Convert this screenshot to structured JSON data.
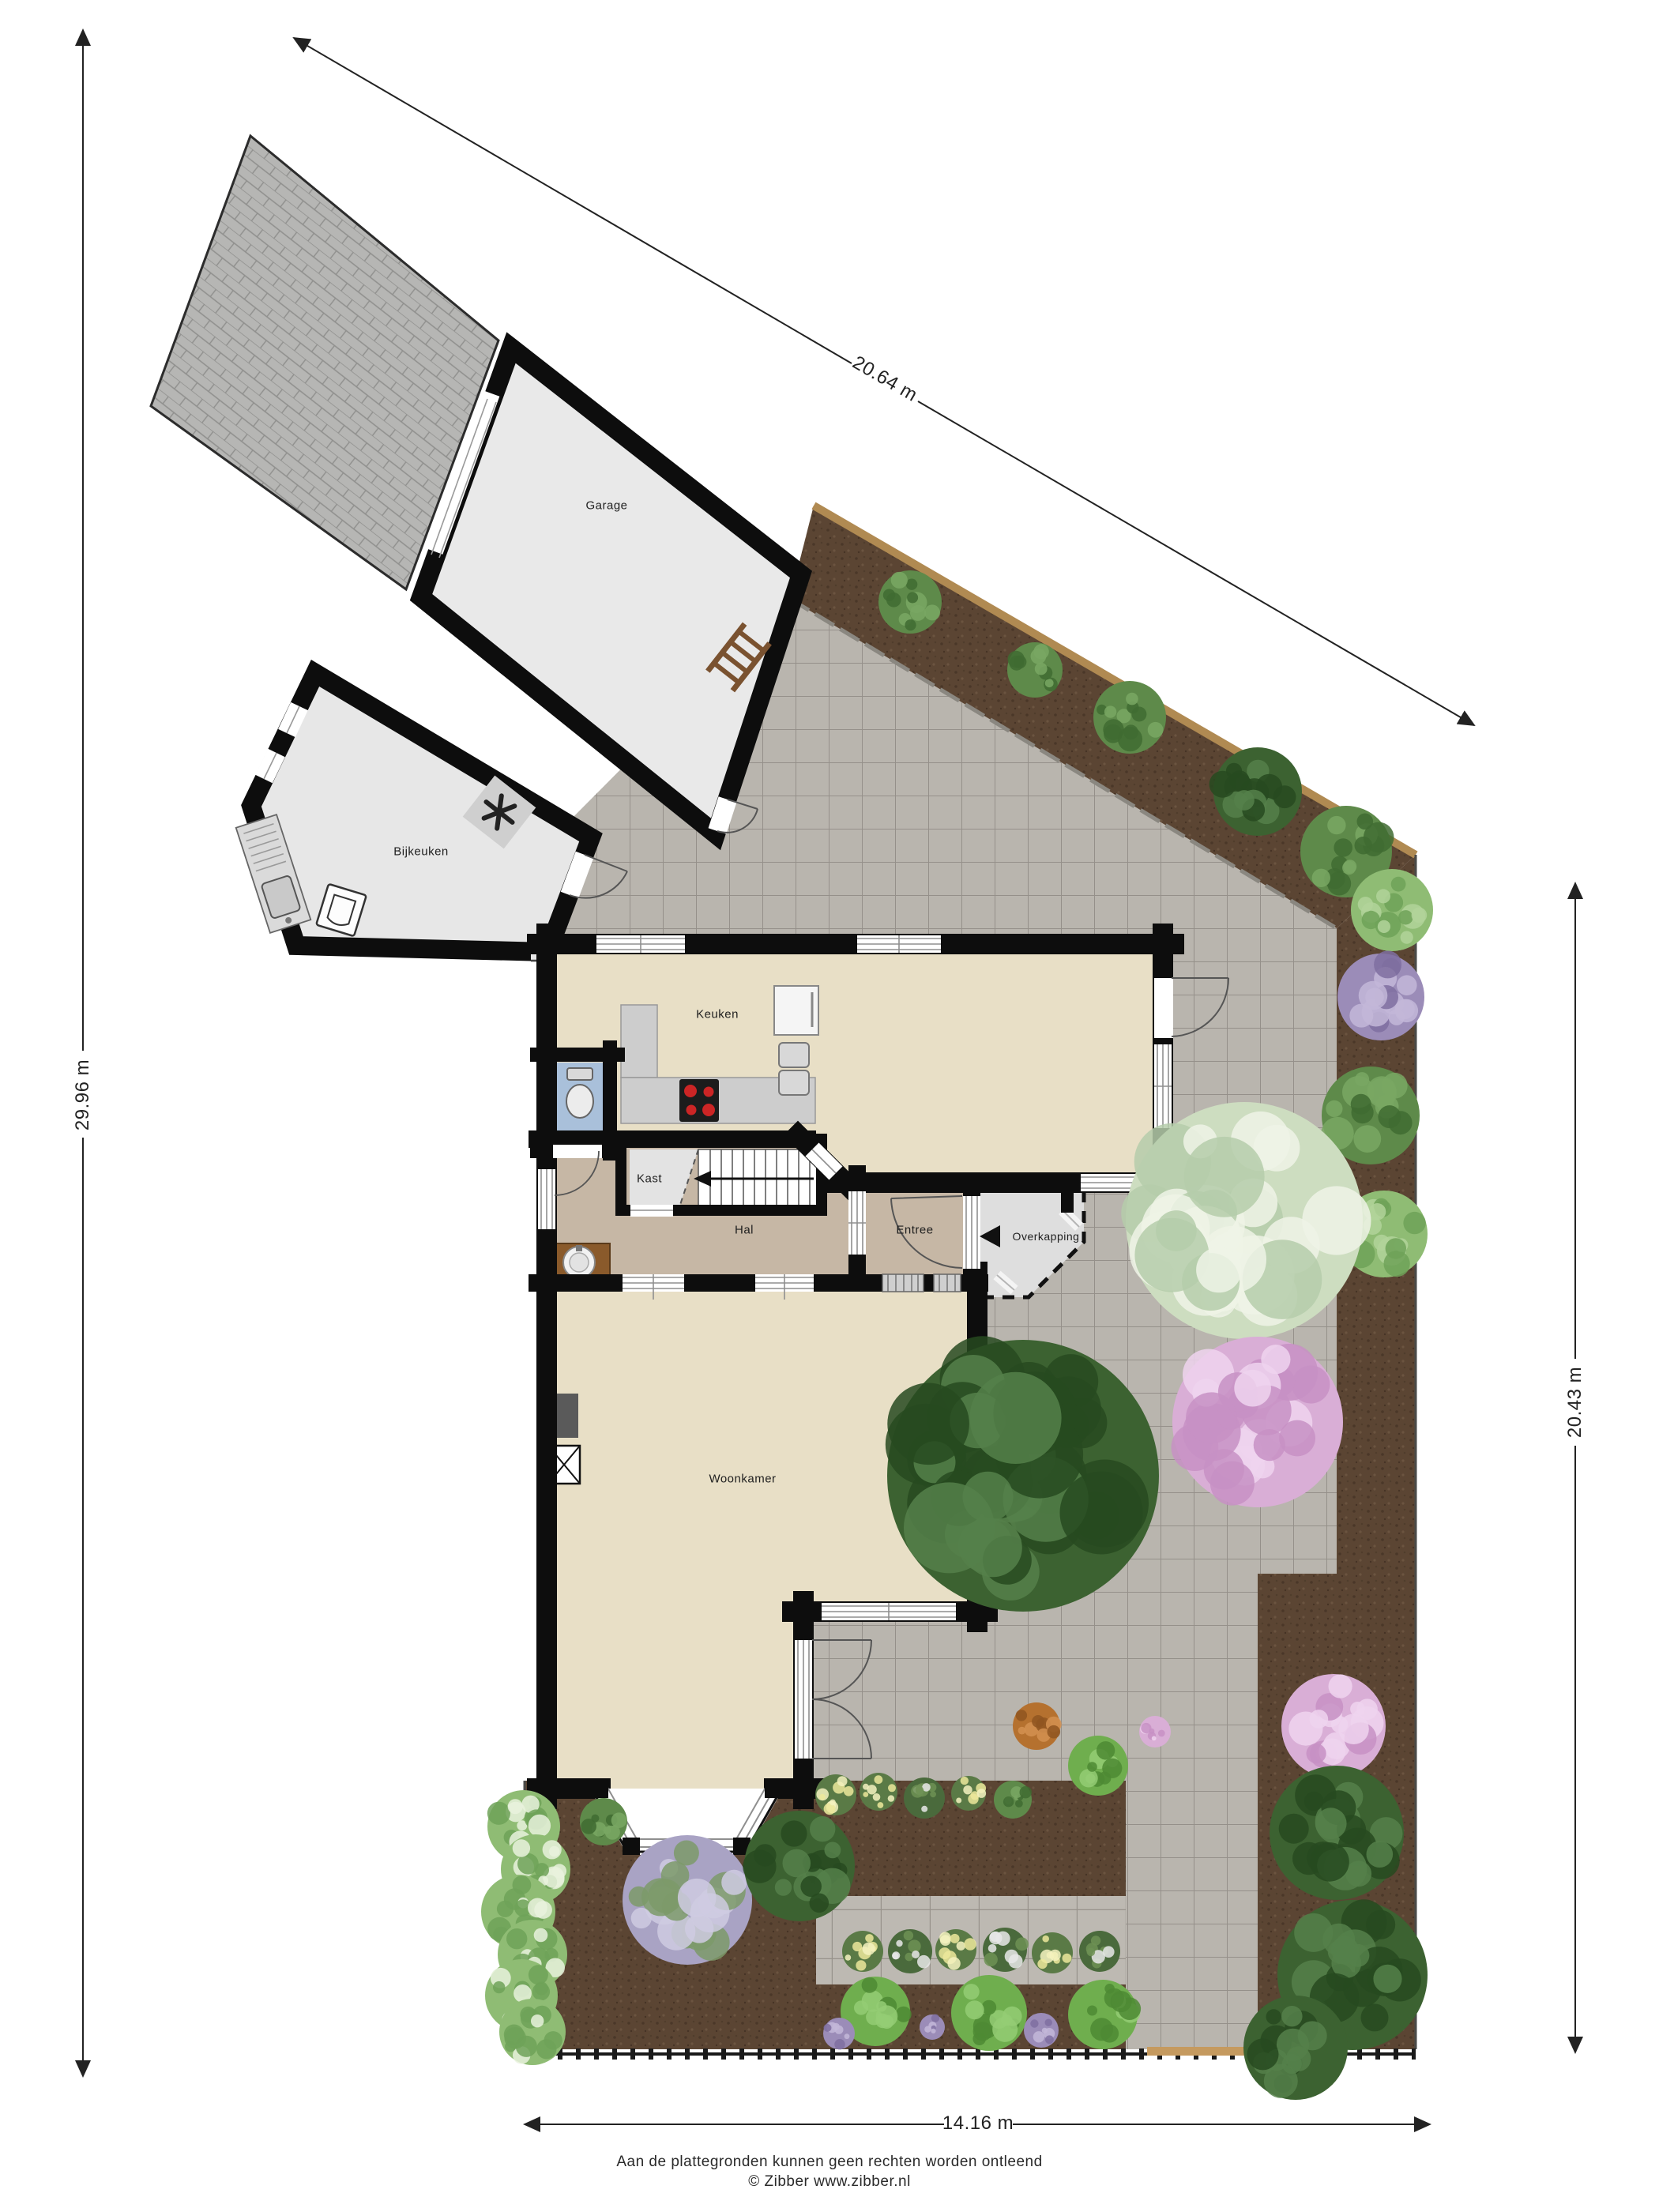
{
  "plan": {
    "rooms": {
      "garage": "Garage",
      "bijkeuken": "Bijkeuken",
      "keuken": "Keuken",
      "kast": "Kast",
      "hal": "Hal",
      "entree": "Entree",
      "overkapping": "Overkapping",
      "woonkamer": "Woonkamer"
    },
    "dimensions": {
      "top": "20.64 m",
      "left": "29.96 m",
      "right": "20.43 m",
      "bottom": "14.16 m"
    },
    "footer": {
      "line1": "Aan de plattegronden kunnen geen rechten worden ontleend",
      "line2": "© Zibber www.zibber.nl"
    },
    "icons": {
      "toilet": "toilet-icon",
      "stove": "stove-icon",
      "sink": "sink-icon",
      "fridge": "cabinet-icon",
      "washer": "washing-machine-icon",
      "fan": "ventilation-icon",
      "ladder": "ladder-icon",
      "basin": "washbasin-icon",
      "fireplace": "fireplace-icon",
      "stairs": "stairs-icon",
      "direction_arrow": "left-arrow-icon"
    },
    "colors": {
      "wall": "#0d0d0d",
      "living_floor": "#e8dfc6",
      "hall_floor": "#c6b7a5",
      "utility_floor": "#e7e7e7",
      "toilet_floor": "#a9c0da",
      "patio_tile": "#b9b5ae",
      "soil": "#5b4533",
      "driveway": "#b6b6b4",
      "wood_edge": "#b08a52"
    }
  }
}
